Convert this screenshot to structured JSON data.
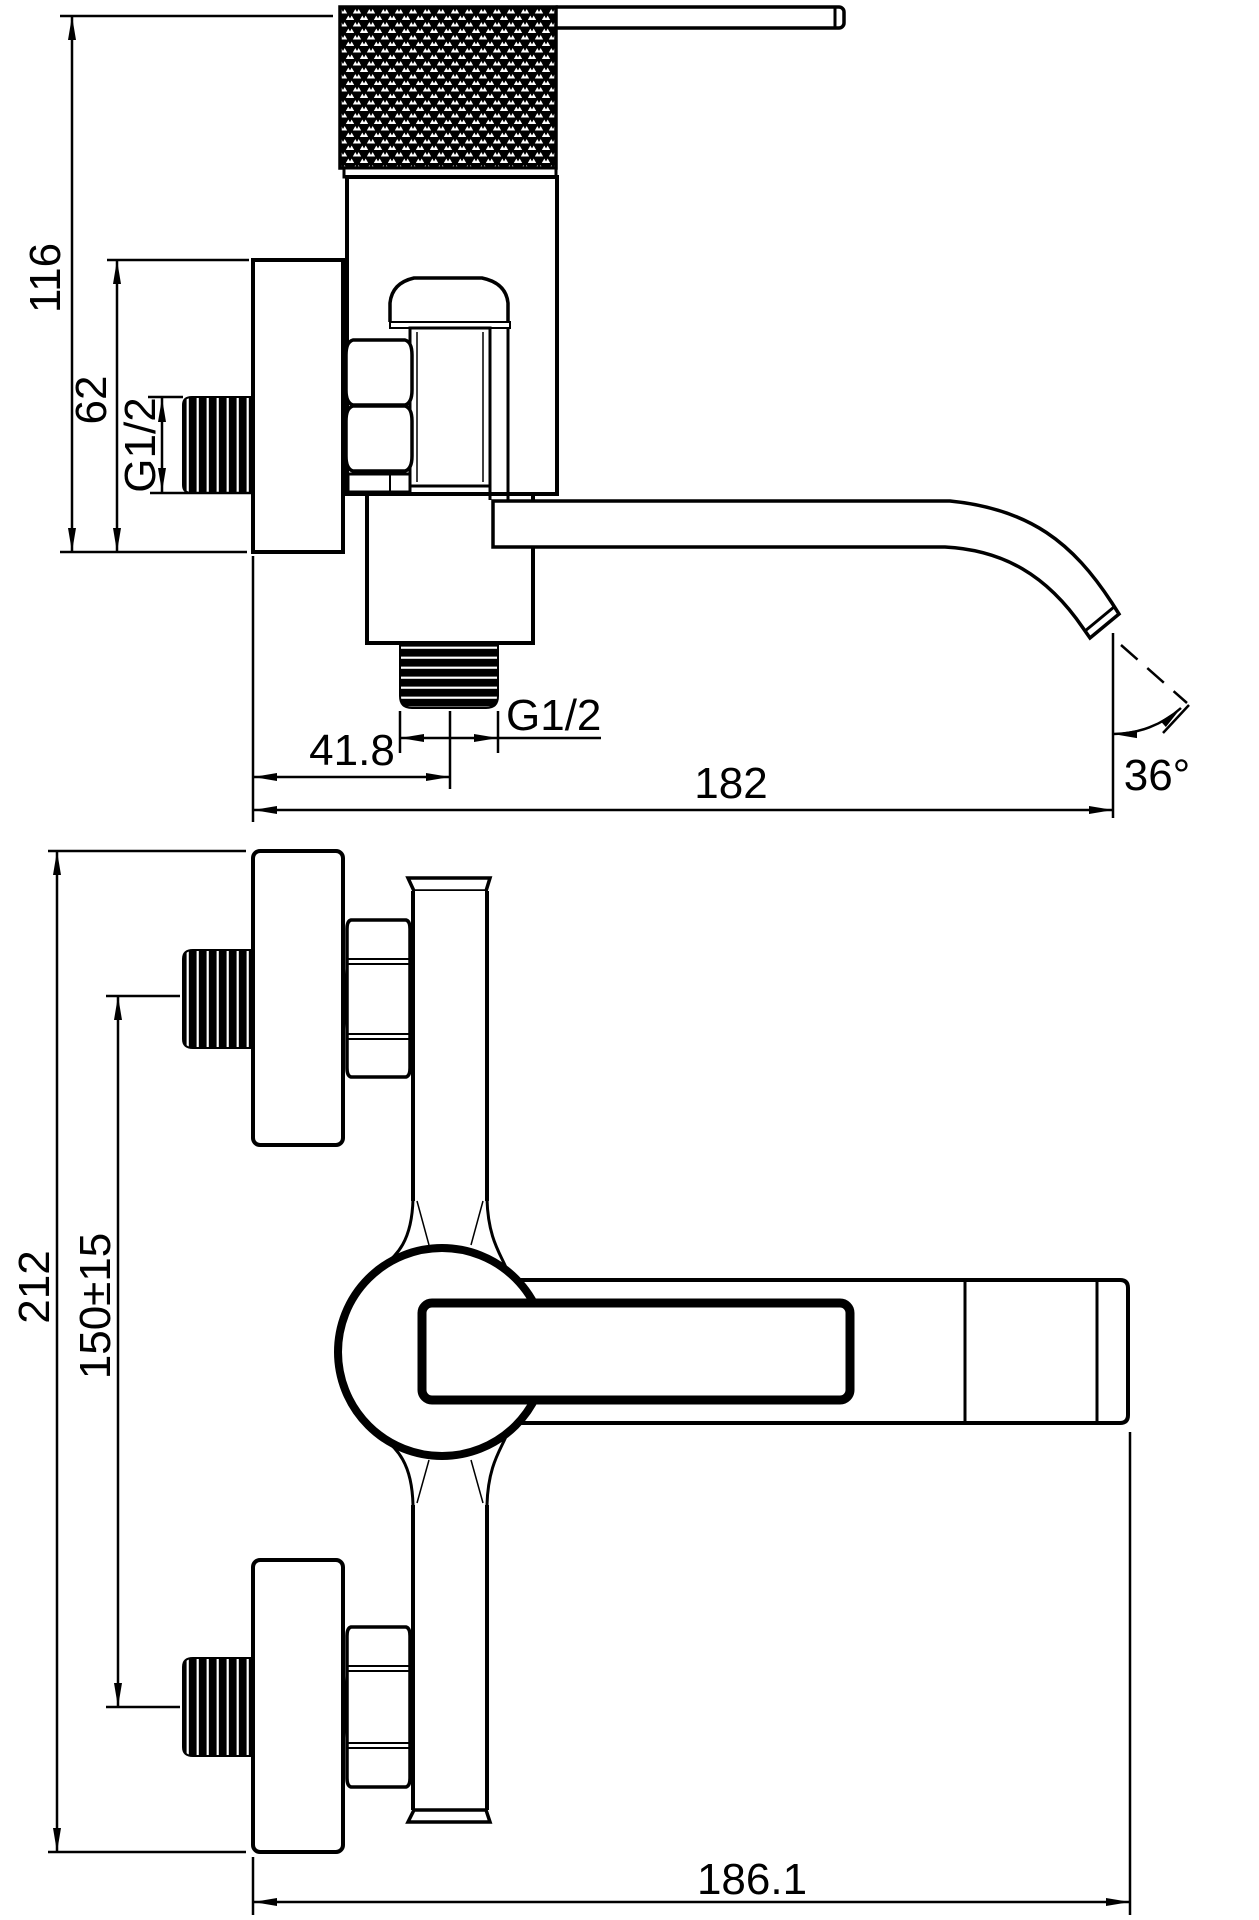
{
  "drawing": {
    "type": "technical-drawing",
    "subject": "wall-mounted single-lever bath mixer faucet, two dimensioned orthographic views",
    "colors": {
      "line": "#000000",
      "background": "#ffffff"
    },
    "views": {
      "side": {
        "name": "side-elevation",
        "dimensions": {
          "overall_height": "116",
          "plate_height": "62",
          "inlet_thread": "G1/2",
          "outlet_thread": "G1/2",
          "outlet_offset": "41.8",
          "overall_length": "182",
          "spout_angle": "36°"
        }
      },
      "front": {
        "name": "front-elevation",
        "dimensions": {
          "overall_height": "212",
          "inlet_spacing": "150±15",
          "overall_width": "186.1"
        }
      }
    }
  }
}
